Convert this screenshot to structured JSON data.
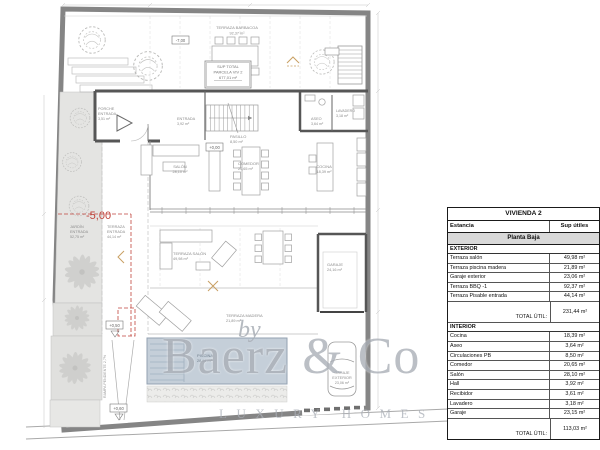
{
  "watermark": {
    "by": "by",
    "brand": "Baerz & Co",
    "tagline": "LUXURY HOMES"
  },
  "plan": {
    "levels": {
      "m7": "-7,00",
      "p0": "+0,00",
      "p050": "+0,50",
      "p060": "+0,60",
      "m5": "-5,00"
    },
    "parcel": {
      "l1": "SUP TOTAL",
      "l2": "PARCELA VIV 2",
      "l3": "677,01 m²"
    },
    "ramp": "RAMPA PENDIENTE 2,7%",
    "rooms": [
      {
        "l1": "TERRAZA BARBACOA",
        "l2": "",
        "area": "92,37 m²"
      },
      {
        "l1": "PORCHE",
        "l2": "ENTRADA",
        "area": "3,51 m²"
      },
      {
        "l1": "ENTRADA",
        "l2": "",
        "area": "3,92 m²"
      },
      {
        "l1": "PASILLO",
        "l2": "",
        "area": "8,50 m²"
      },
      {
        "l1": "SALÓN",
        "l2": "",
        "area": "28,10 m²"
      },
      {
        "l1": "COMEDOR",
        "l2": "",
        "area": "20,65 m²"
      },
      {
        "l1": "ASEO",
        "l2": "",
        "area": "3,64 m²"
      },
      {
        "l1": "LAVADERO",
        "l2": "",
        "area": "3,18 m²"
      },
      {
        "l1": "COCINA",
        "l2": "",
        "area": "18,39 m²"
      },
      {
        "l1": "JARDÍN",
        "l2": "ENTRADA",
        "area": "52,75 m²"
      },
      {
        "l1": "TERRAZA",
        "l2": "ENTRADA",
        "area": "44,14 m²"
      },
      {
        "l1": "TERRAZA SALÓN",
        "l2": "",
        "area": "49,98 m²"
      },
      {
        "l1": "TERRAZA MADERA",
        "l2": "",
        "area": "21,89 m²"
      },
      {
        "l1": "PISCINA",
        "l2": "",
        "area": "28,04 m²"
      },
      {
        "l1": "GARAJE",
        "l2": "",
        "area": "24,16 m²"
      },
      {
        "l1": "GARAJE",
        "l2": "EXTERIOR",
        "area": "23,06 m²"
      }
    ]
  },
  "table": {
    "title": "VIVIENDA 2",
    "col_estancia": "Estancia",
    "col_sup": "Sup útiles",
    "floor": "Planta Baja",
    "sections": [
      {
        "label": "EXTERIOR",
        "rows": [
          {
            "label": "Terraza salón",
            "value": "49,98 m²"
          },
          {
            "label": "Terraza piscina madera",
            "value": "21,89 m²"
          },
          {
            "label": "Garaje exterior",
            "value": "23,06 m²"
          },
          {
            "label": "Terraza BBQ -1",
            "value": "92,37 m²"
          },
          {
            "label": "Terraza Pisable entrada",
            "value": "44,14 m²"
          }
        ],
        "total_label": "TOTAL ÚTIL:",
        "total": "231,44 m²"
      },
      {
        "label": "INTERIOR",
        "rows": [
          {
            "label": "Cocina",
            "value": "18,39 m²"
          },
          {
            "label": "Aseo",
            "value": "3,64 m²"
          },
          {
            "label": "Circulaciones PB",
            "value": "8,50 m²"
          },
          {
            "label": "Comedor",
            "value": "20,65 m²"
          },
          {
            "label": "Salón",
            "value": "28,10 m²"
          },
          {
            "label": "Hall",
            "value": "3,92 m²"
          },
          {
            "label": "Recibidor",
            "value": "3,61 m²"
          },
          {
            "label": "Lavadero",
            "value": "3,18 m²"
          },
          {
            "label": "Garaje",
            "value": "23,15 m²"
          }
        ],
        "total_label": "TOTAL ÚTIL:",
        "total": "113,03 m²"
      }
    ]
  }
}
